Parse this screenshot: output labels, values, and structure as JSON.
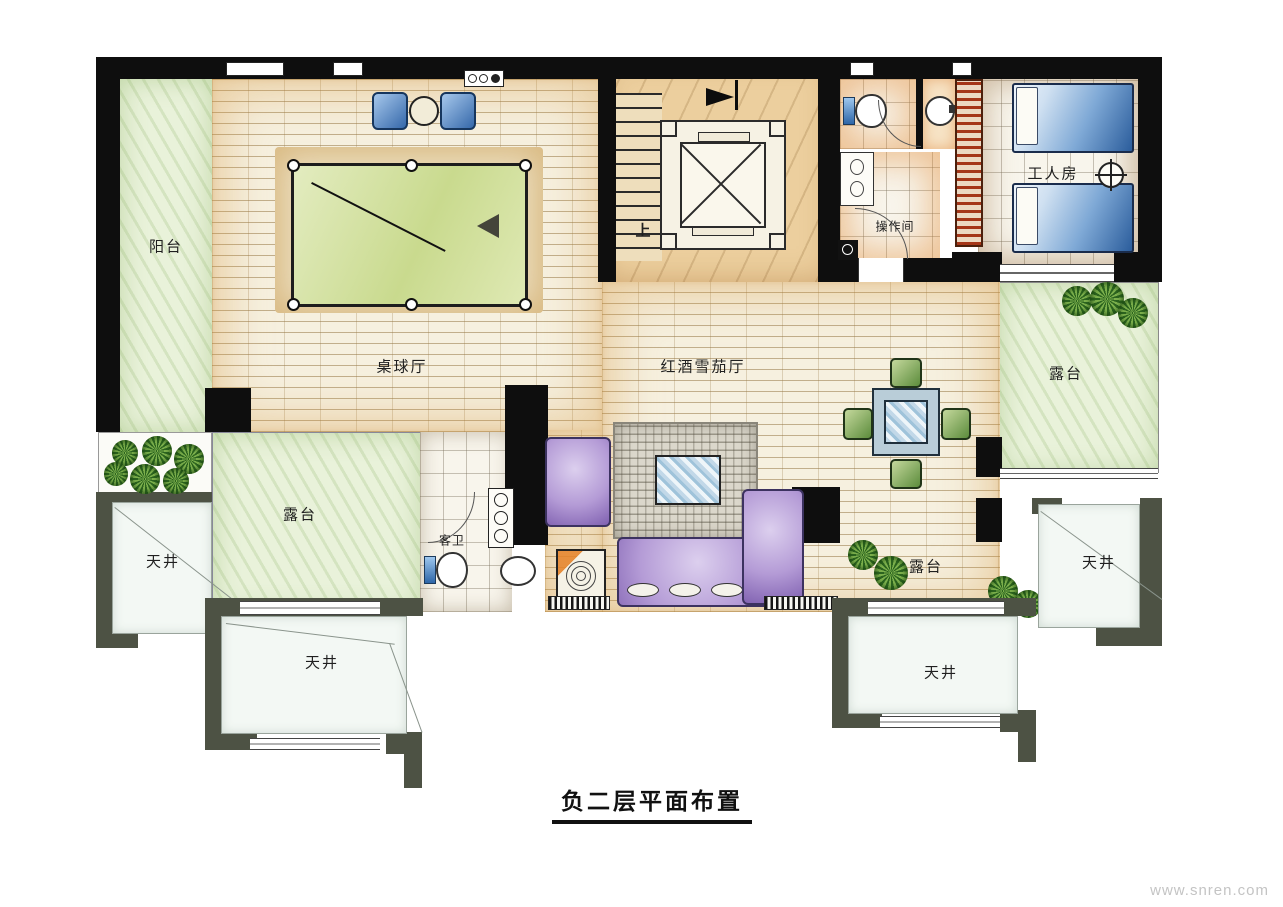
{
  "title": "负二层平面布置",
  "watermark": "www.snren.com",
  "labels": {
    "balcony": "阳台",
    "billiards_hall": "桌球厅",
    "wine_cigar_hall": "红酒雪茄厅",
    "worker_room": "工人房",
    "operation_room": "操作间",
    "guest_bath": "客卫",
    "terrace": "露台",
    "lightwell": "天井",
    "stairs_up": "上"
  },
  "colors": {
    "wall_black": "#0e0e0e",
    "outer_wall_gray": "#4d5244",
    "brick_floor": "#f6f0df",
    "marble_floor": "#eccf9e",
    "terrace_green": "#e9f2da",
    "tile_white": "#f8f5ec",
    "lightwell_floor": "#f3f8f4",
    "billiard_felt": "#cfdf9d",
    "sofa_purple": "#b49bd6",
    "chair_blue": "#3568aa",
    "chair_green": "#5c8c3c",
    "bed_blue": "#2b5d9c",
    "red_rack": "#a53618",
    "rug_gray": "#dbd7cb"
  }
}
